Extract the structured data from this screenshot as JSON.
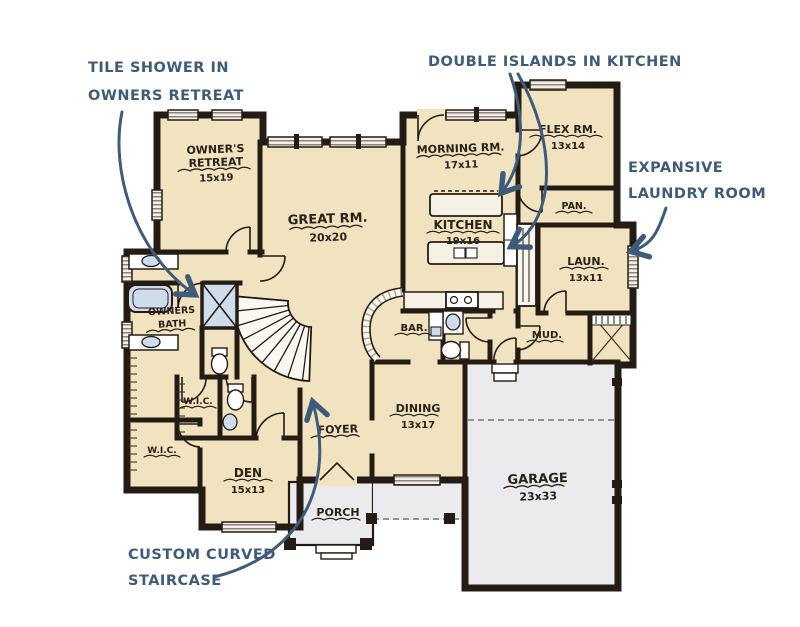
{
  "colors": {
    "paper": "#ffffff",
    "room_fill": "#f2e3c0",
    "garage_fill": "#ebebee",
    "wall_ink": "#241c14",
    "annotation_blue": "#3e5c79",
    "fixture_blue": "#cfdcec"
  },
  "annotations": {
    "tile_shower": {
      "line1": "TILE SHOWER IN",
      "line2": "OWNERS RETREAT"
    },
    "double_islands": {
      "line1": "DOUBLE ISLANDS IN KITCHEN"
    },
    "laundry": {
      "line1": "EXPANSIVE",
      "line2": "LAUNDRY ROOM"
    },
    "staircase": {
      "line1": "CUSTOM CURVED",
      "line2": "STAIRCASE"
    }
  },
  "rooms": {
    "owners_retreat": {
      "line1": "OWNER'S",
      "line2": "RETREAT",
      "dims": "15x19"
    },
    "great_rm": {
      "name": "GREAT RM.",
      "dims": "20x20"
    },
    "morning_rm": {
      "name": "MORNING RM.",
      "dims": "17x11"
    },
    "flex_rm": {
      "name": "FLEX RM.",
      "dims": "13x14"
    },
    "kitchen": {
      "name": "KITCHEN",
      "dims": "19x16"
    },
    "pantry": {
      "name": "PAN."
    },
    "laundry": {
      "name": "LAUN.",
      "dims": "13x11"
    },
    "mud": {
      "name": "MUD."
    },
    "bar": {
      "name": "BAR."
    },
    "owners_bath": {
      "line1": "OWNERS",
      "line2": "BATH"
    },
    "wic_upper": {
      "name": "W.I.C."
    },
    "wic_lower": {
      "name": "W.I.C."
    },
    "den": {
      "name": "DEN",
      "dims": "15x13"
    },
    "foyer": {
      "name": "FOYER"
    },
    "dining": {
      "name": "DINING",
      "dims": "13x17"
    },
    "garage": {
      "name": "GARAGE",
      "dims": "23x33"
    },
    "porch": {
      "name": "PORCH"
    }
  }
}
